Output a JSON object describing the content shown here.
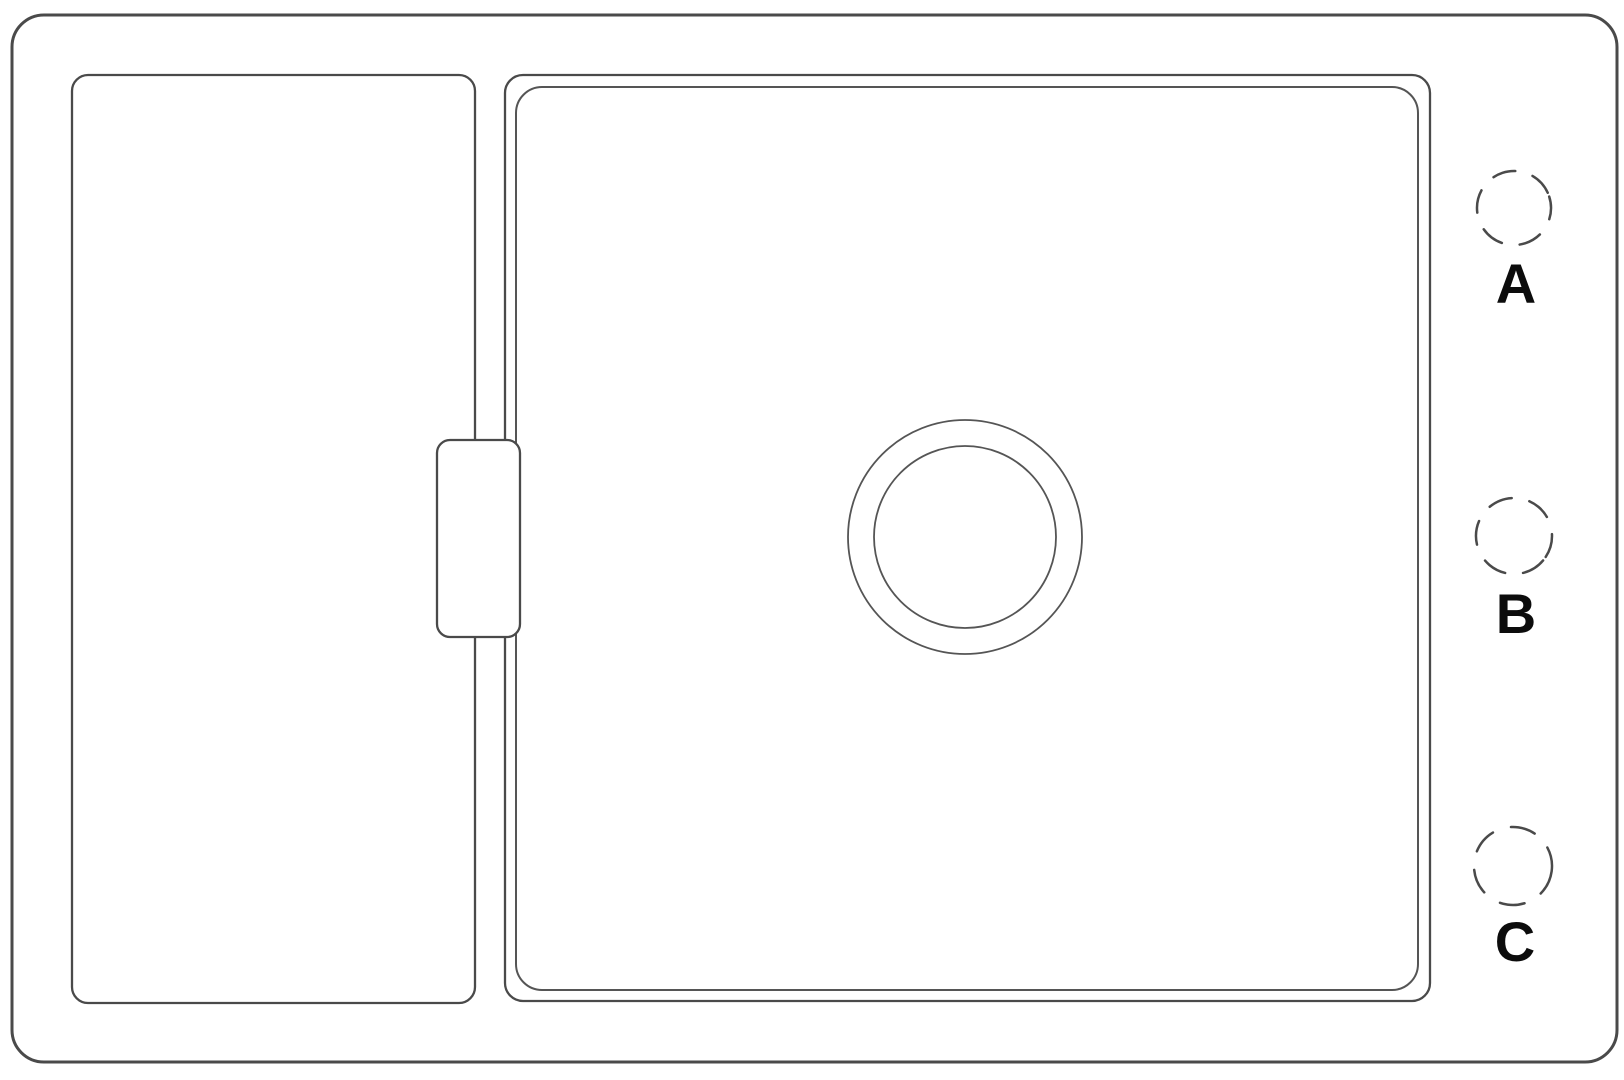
{
  "drawing": {
    "tap_hole_labels": {
      "a": "A",
      "b": "B",
      "c": "C"
    }
  },
  "colors": {
    "background": "#ffffff",
    "line": "#4a4a4a",
    "thin_line": "#555555",
    "label_text": "#0c0c0c"
  }
}
